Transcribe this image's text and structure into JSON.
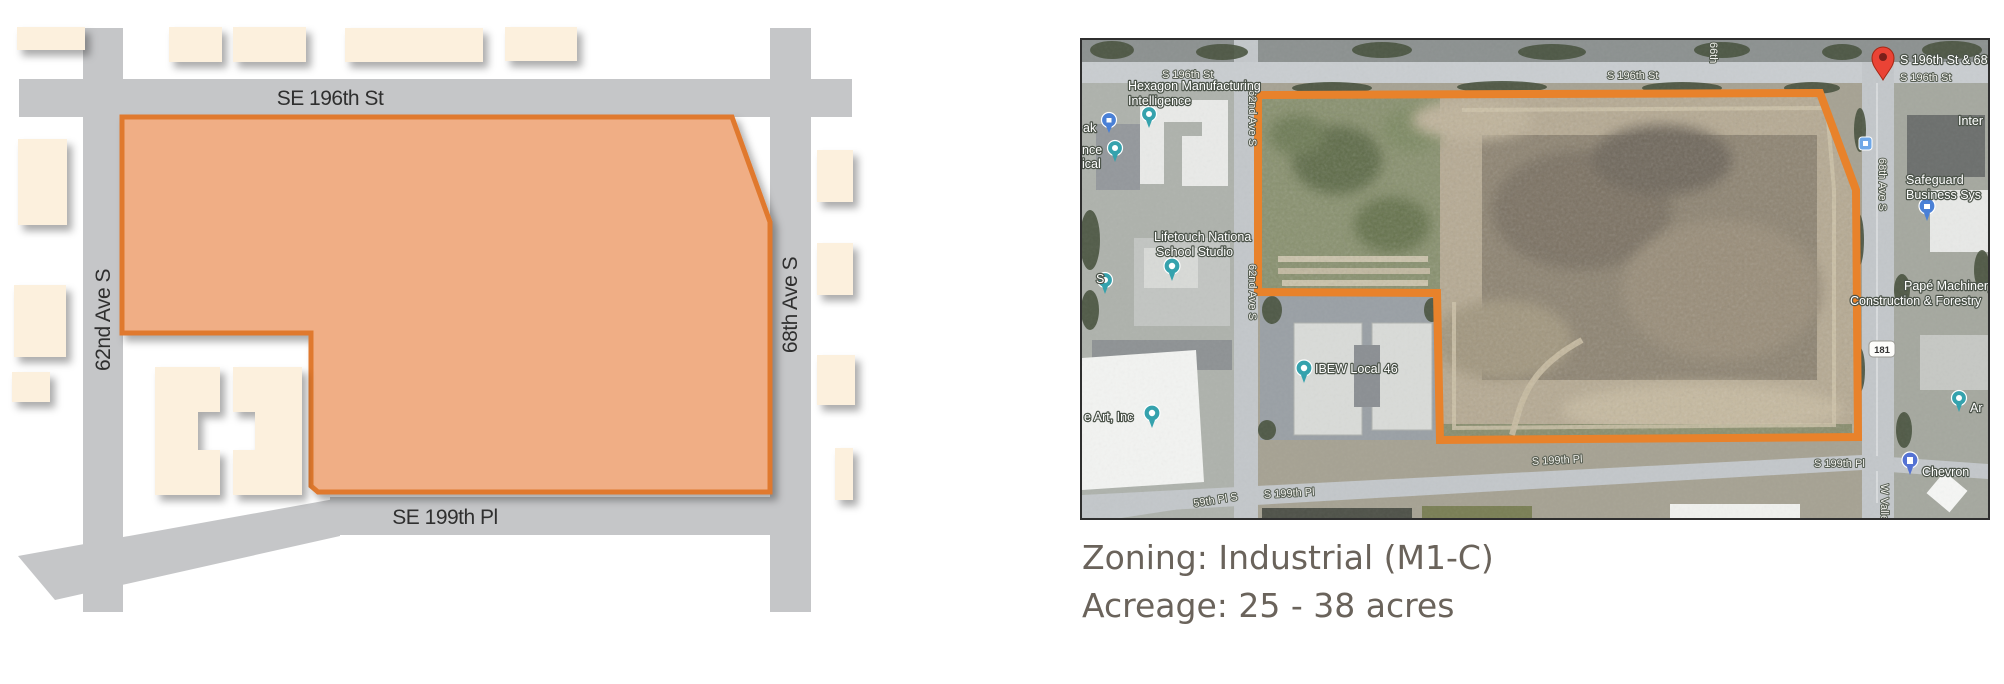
{
  "site_diagram": {
    "street_top": "SE 196th St",
    "street_bottom": "SE 199th Pl",
    "street_left": "62nd Ave S",
    "street_right": "68th Ave S"
  },
  "satellite_map": {
    "road_labels": {
      "s196": "S 196th St",
      "ave62": "62nd Ave S",
      "ave66": "66th",
      "ave68": "68th Ave S",
      "s199": "S 199th Pl",
      "pl59": "59th Pl S",
      "w_valley": "W Valley Hwy",
      "route_shield": "181"
    },
    "place_labels": {
      "pin_title": "S 196th St & 68th Ave S",
      "hexagon_line1": "Hexagon Manufacturing",
      "hexagon_line2": "Intelligence",
      "lifetouch_line1": "Lifetouch Nationa",
      "lifetouch_line2": "School Studio",
      "ibew": "IBEW Local 46",
      "art_inc": "e Art, Inc",
      "safeguard_line1": "Safeguard",
      "safeguard_line2": "Business Sys",
      "pape_line1": "Papé Machinery",
      "pape_line2": "Construction & Forestry",
      "inter": "Inter",
      "chevron": "Chevron",
      "ar": "Ar",
      "edge_ak": "ak",
      "edge_nce": "nce",
      "edge_ical": "ical",
      "edge_s": "S"
    }
  },
  "caption": {
    "zoning": "Zoning: Industrial (M1-C)",
    "acreage": "Acreage: 25 - 38 acres"
  },
  "colors": {
    "parcel_fill": "#f0ae85",
    "parcel_border": "#e0792f",
    "road_gray": "#c5c6c8",
    "building_cream": "#fcf0dd",
    "outline_orange": "#e8822b",
    "caption_text": "#6a635b"
  }
}
